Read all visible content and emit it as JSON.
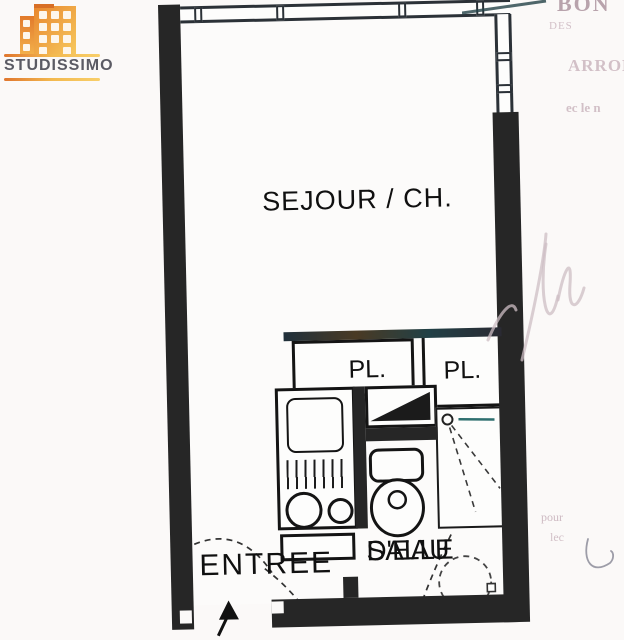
{
  "logo": {
    "brand": "STUDISSIMO"
  },
  "plan": {
    "rooms": {
      "sejour": "SEJOUR / CH.",
      "entree": "ENTREE",
      "salle_deau_line1": "SALLE",
      "salle_deau_line2": "D'EAU",
      "placard_left": "PL.",
      "placard_right": "PL."
    }
  },
  "ghost_text": {
    "t1": "BON",
    "t2": "DES",
    "t3": "ARRON",
    "t4": "ec le n",
    "t5": "pour",
    "t6": "lec"
  },
  "colors": {
    "wall": "#262626",
    "brand_orange": "#ef9a3d",
    "brand_text": "#5b5b64",
    "shower_line_teal": "#2e6f6f",
    "ghost_pink": "#a07a8c",
    "paper": "#fbf9f8"
  }
}
